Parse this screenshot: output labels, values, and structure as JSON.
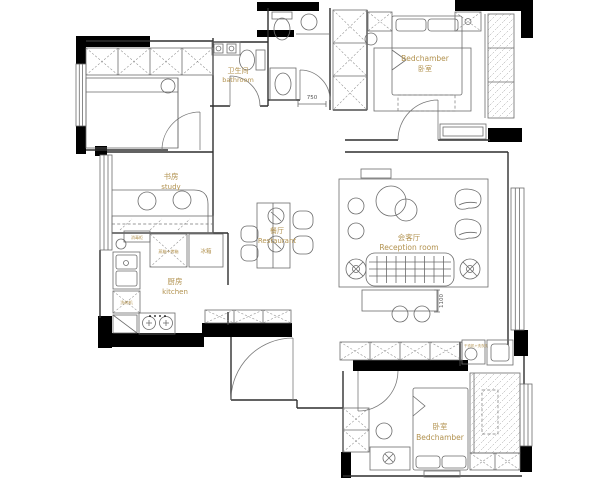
{
  "palette": {
    "wall": "#000000",
    "line": "#6b6b6b",
    "label_gold": "#b2924f",
    "dim_gray": "#555555",
    "background": "#ffffff"
  },
  "rooms": {
    "bathroom": {
      "zh": "卫生间",
      "en": "bathroom"
    },
    "bedroom_top": {
      "en": "Bedchamber",
      "zh": "卧室"
    },
    "study": {
      "zh": "书房",
      "en": "study"
    },
    "kitchen": {
      "zh": "厨房",
      "en": "kitchen"
    },
    "dining": {
      "zh": "餐厅",
      "en": "Restaurant"
    },
    "reception": {
      "zh": "会客厅",
      "en": "Reception room"
    },
    "bedroom_bottom": {
      "zh": "卧室",
      "en": "Bedchamber"
    }
  },
  "appliances": {
    "steam_oven": "蒸箱+烤箱",
    "fridge": "冰箱",
    "dishwasher": "洗碗机",
    "disinfection_cabinet": "消毒柜",
    "washer_dryer": "干衣机+洗衣机"
  },
  "dimensions": {
    "corridor": "750",
    "tv_wall": "1100"
  }
}
